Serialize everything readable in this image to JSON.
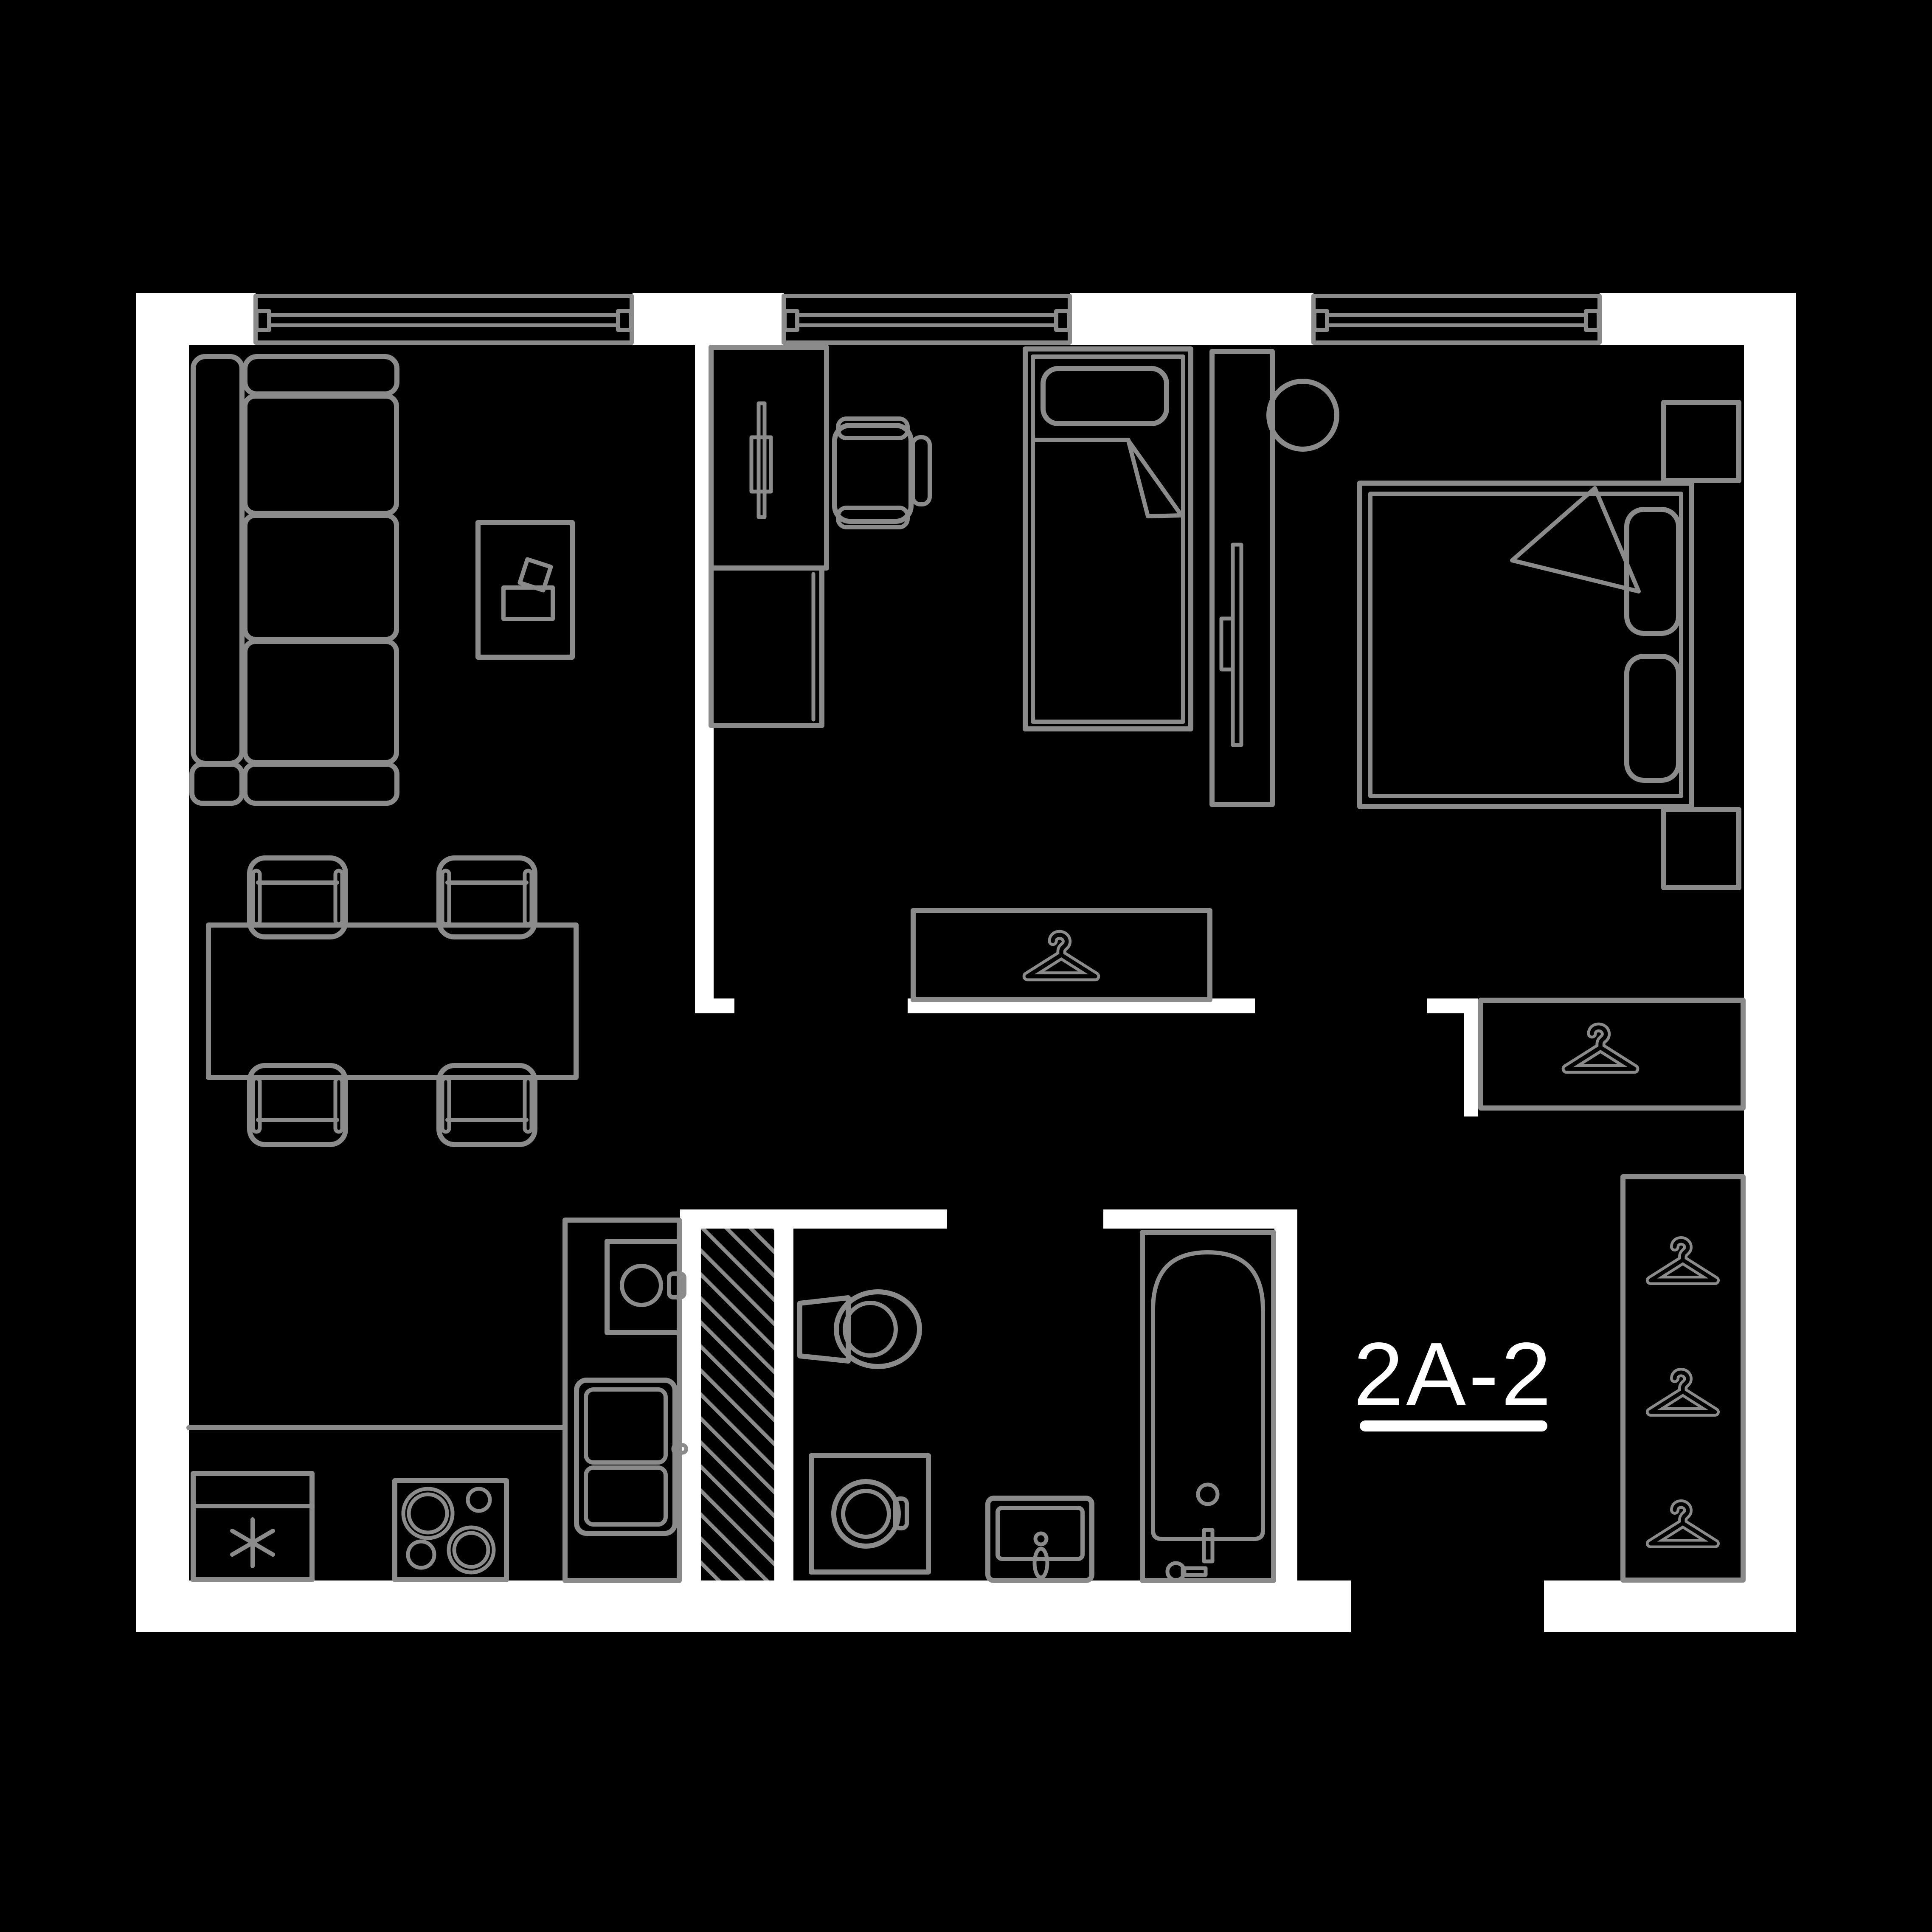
{
  "unit_label": {
    "text": "2A-2"
  },
  "colors": {
    "background": "#000000",
    "wall": "#ffffff",
    "line": "#8b8b8b",
    "label": "#ffffff"
  },
  "icons": {
    "hanger": "coat-hanger symbol marking closets and wardrobes",
    "window": "double-line window symbol set into outer wall openings",
    "asterisk": "six-spoke freezer symbol on kitchen unit",
    "hatch": "diagonal hatching marking the service shaft"
  },
  "plan": {
    "type": "two-bedroom apartment floor plan, white walls on black",
    "windows": 3,
    "hanger_symbols": 5,
    "areas": [
      "living room: sofa, side table, dining table with four chairs",
      "kitchen: freezer unit, cooktop with four burners, sink, fridge",
      "bedroom 2: desk with lamp, desk chair, cabinet, single bed, closet with hanger",
      "master bedroom: wardrobe cabinet, round mirror, double bed with two pillows, two nightstands",
      "bathroom: toilet, washing machine, washbasin, bathtub",
      "service shaft with diagonal hatch",
      "entry hall: closet niche with hanger, tall wardrobe with three hangers, unit label"
    ]
  }
}
